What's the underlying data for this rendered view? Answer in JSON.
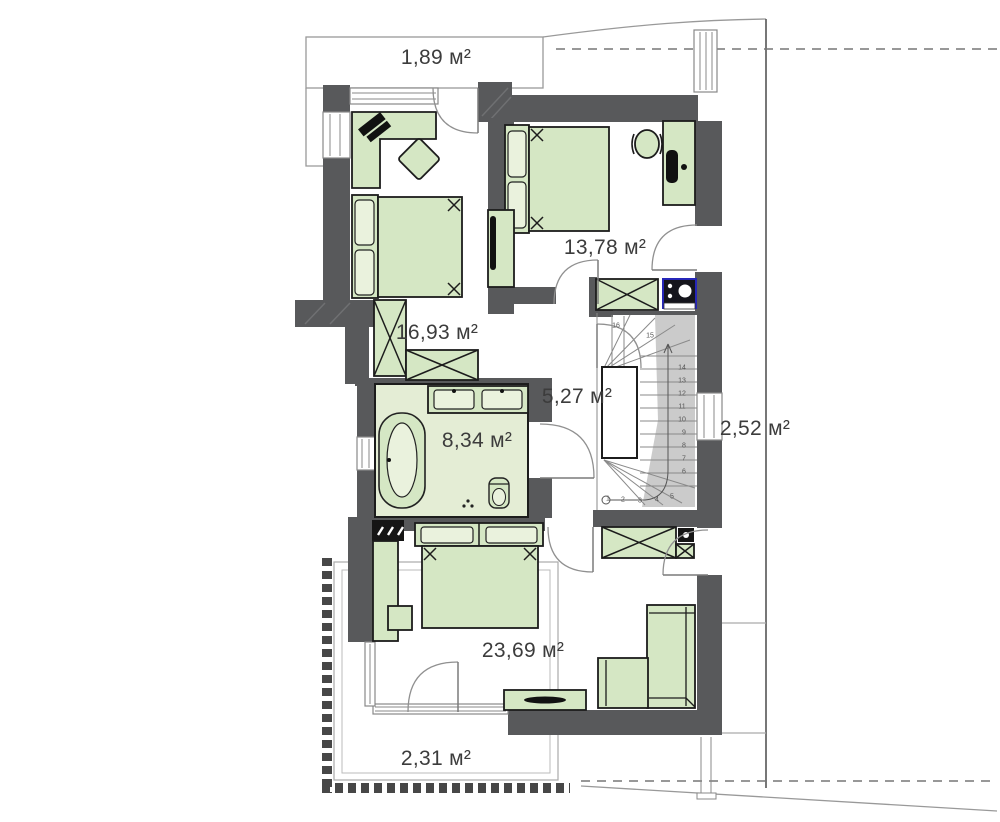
{
  "plan": {
    "title": "storey-floor-plan",
    "rooms": [
      {
        "id": "balcony-top",
        "area": "1,89 м²"
      },
      {
        "id": "bedroom-right",
        "area": "13,78 м²"
      },
      {
        "id": "bedroom-left",
        "area": "16,93 м²"
      },
      {
        "id": "hall",
        "area": "5,27 м²"
      },
      {
        "id": "bathroom",
        "area": "8,34 м²"
      },
      {
        "id": "roof-terrace",
        "area": "2,52 м²"
      },
      {
        "id": "bedroom-bottom",
        "area": "23,69 м²"
      },
      {
        "id": "balcony-bottom",
        "area": "2,31 м²"
      }
    ],
    "stairs": {
      "step_numbers": [
        "1",
        "2",
        "3",
        "4",
        "5",
        "6",
        "7",
        "8",
        "9",
        "10",
        "11",
        "12",
        "13",
        "14",
        "15",
        "16"
      ]
    },
    "colors": {
      "wall": "#58595b",
      "furniture_fill": "#d5e7c4",
      "furniture_stroke": "#1c1c1c",
      "bathroom_floor": "#e4edd5",
      "stair_shade": "#cbcbcb",
      "appliance_accent": "#2626b8",
      "outline": "#999999",
      "label_text": "#3c3c3c"
    }
  }
}
